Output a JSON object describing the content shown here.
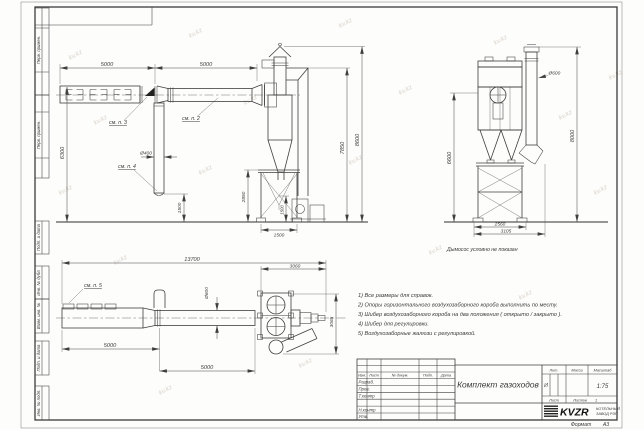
{
  "frame": {
    "stamps_top": [
      "Перв. примен.",
      "Перв. примен."
    ],
    "stamps_bottom": [
      "Подп. и дата",
      "Инв. № дубл.",
      "Взам. инв. №",
      "Подп. и дата",
      "Инв. № подл."
    ],
    "format_label": "Формат",
    "format_value": "А3"
  },
  "watermark": {
    "text": "kv.kz"
  },
  "views": {
    "side": {
      "dim_5000_a": "5000",
      "dim_5000_b": "5000",
      "dim_6300": "6300",
      "dim_d400": "Ø400",
      "dim_1500_pipe": "1500",
      "dim_2850": "2850",
      "dim_1500_bin": "1500",
      "dim_1500_base": "1500",
      "dim_7850": "7850",
      "dim_8600": "8600",
      "ref2": "см. п. 2",
      "ref3": "см. п. 3",
      "ref4": "см. п. 4"
    },
    "cyclone": {
      "dim_d600": "Ø600",
      "dim_6600": "6600",
      "dim_8000": "8000",
      "dim_2560": "2560",
      "dim_3105": "3105",
      "caption": "Дымосос условно не показан"
    },
    "plan": {
      "dim_13700": "13700",
      "dim_3060": "3060",
      "dim_3065": "3065",
      "dim_d600": "Ø600",
      "dim_5000_a": "5000",
      "dim_5000_b": "5000",
      "ref5": "см. п. 5"
    }
  },
  "notes": {
    "items": [
      "1) Все размеры для справок.",
      "2) Опоры горизонтального воздухозаборного короба выполнить по месту.",
      "3) Шибер воздухозаборного короба на два положения ( открыто / закрыто ).",
      "4) Шибер для регулировки.",
      "5) Воздухозаборные жалюзи с регулировкой."
    ]
  },
  "title_block": {
    "doc_title": "Комплект газоходов",
    "header_cols": [
      "Изм.",
      "Лист",
      "№ докум.",
      "Подп.",
      "Дата"
    ],
    "sig_rows": [
      "Разраб.",
      "Пров.",
      "Т.контр",
      "Н.контр",
      "Утв."
    ],
    "lit_label": "Лит.",
    "lit_value": "И",
    "mass_label": "Масса",
    "scale_label": "Масштаб",
    "scale_value": "1:75",
    "sheet_label": "Лист",
    "sheets_label": "Листов",
    "sheets_value": "1",
    "company_logo": "KVZR",
    "company_line1": "КОТЕЛЬНЫЙ",
    "company_line2": "ЗАВОД РЭП"
  }
}
